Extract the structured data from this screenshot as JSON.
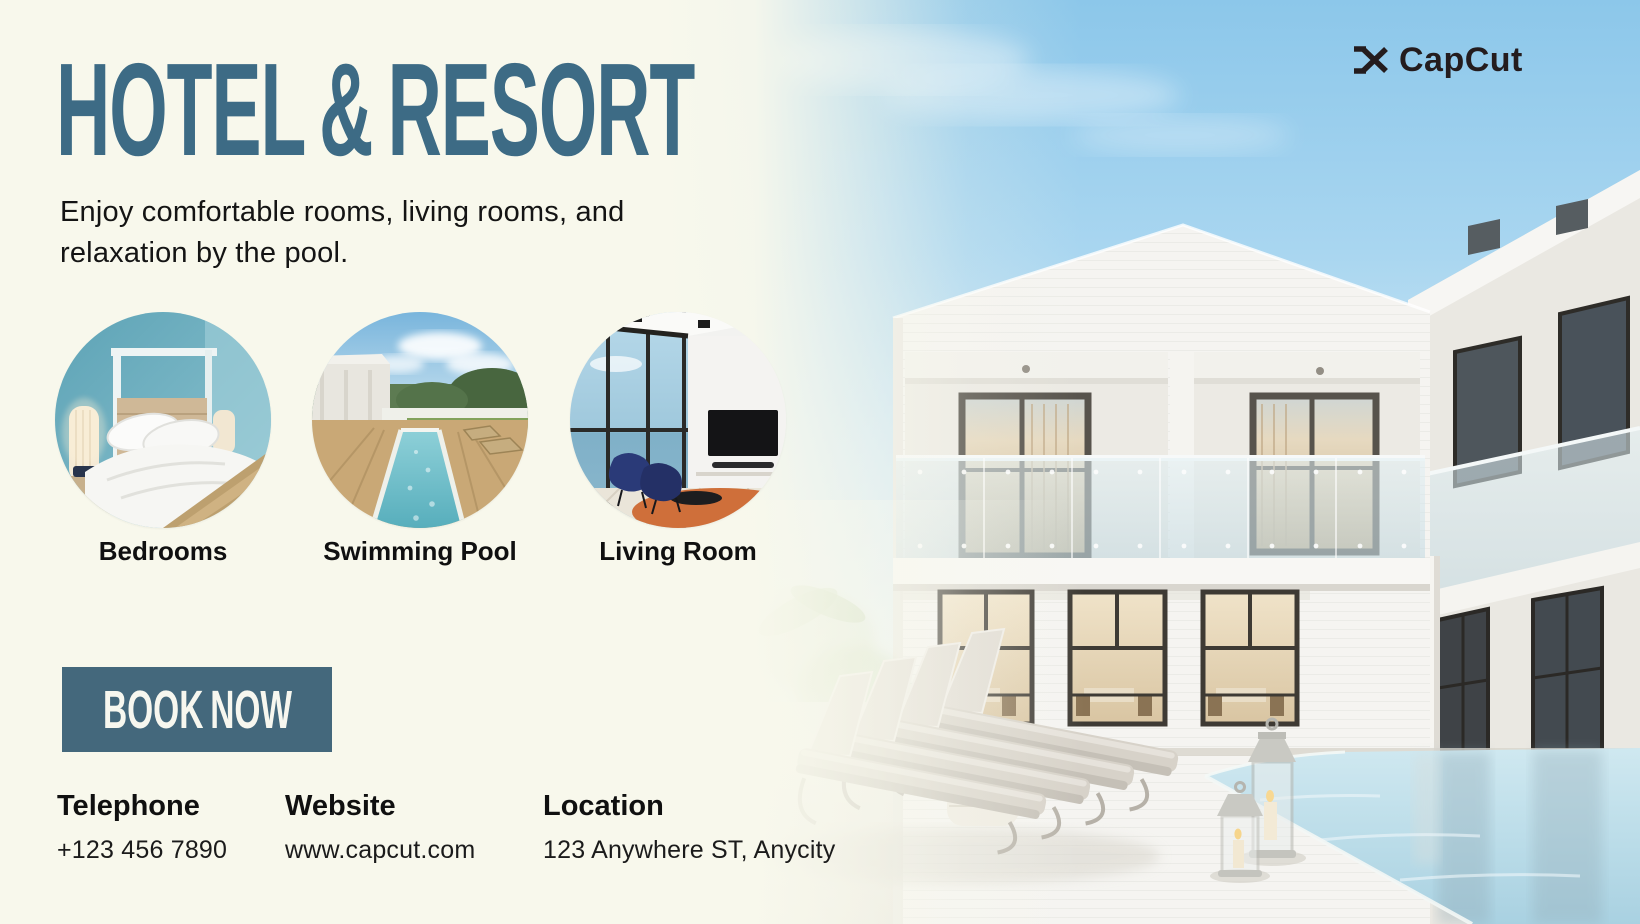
{
  "brand": {
    "name": "CapCut"
  },
  "header": {
    "title": "HOTEL & RESORT",
    "subtitle": "Enjoy comfortable rooms, living rooms, and relaxation by the pool."
  },
  "features": [
    {
      "label": "Bedrooms"
    },
    {
      "label": "Swimming Pool"
    },
    {
      "label": "Living Room"
    }
  ],
  "cta": {
    "label": "BOOK NOW"
  },
  "contact": {
    "telephone": {
      "label": "Telephone",
      "value": "+123 456 7890"
    },
    "website": {
      "label": "Website",
      "value": "www.capcut.com"
    },
    "location": {
      "label": "Location",
      "value": "123 Anywhere ST, Anycity"
    }
  },
  "colors": {
    "background_cream": "#f8f8ec",
    "title_teal": "#3d6b85",
    "button_teal": "#44687c",
    "text_dark": "#141414",
    "logo_dark": "#241c1e",
    "sky_blue": "#8cc7ea"
  }
}
